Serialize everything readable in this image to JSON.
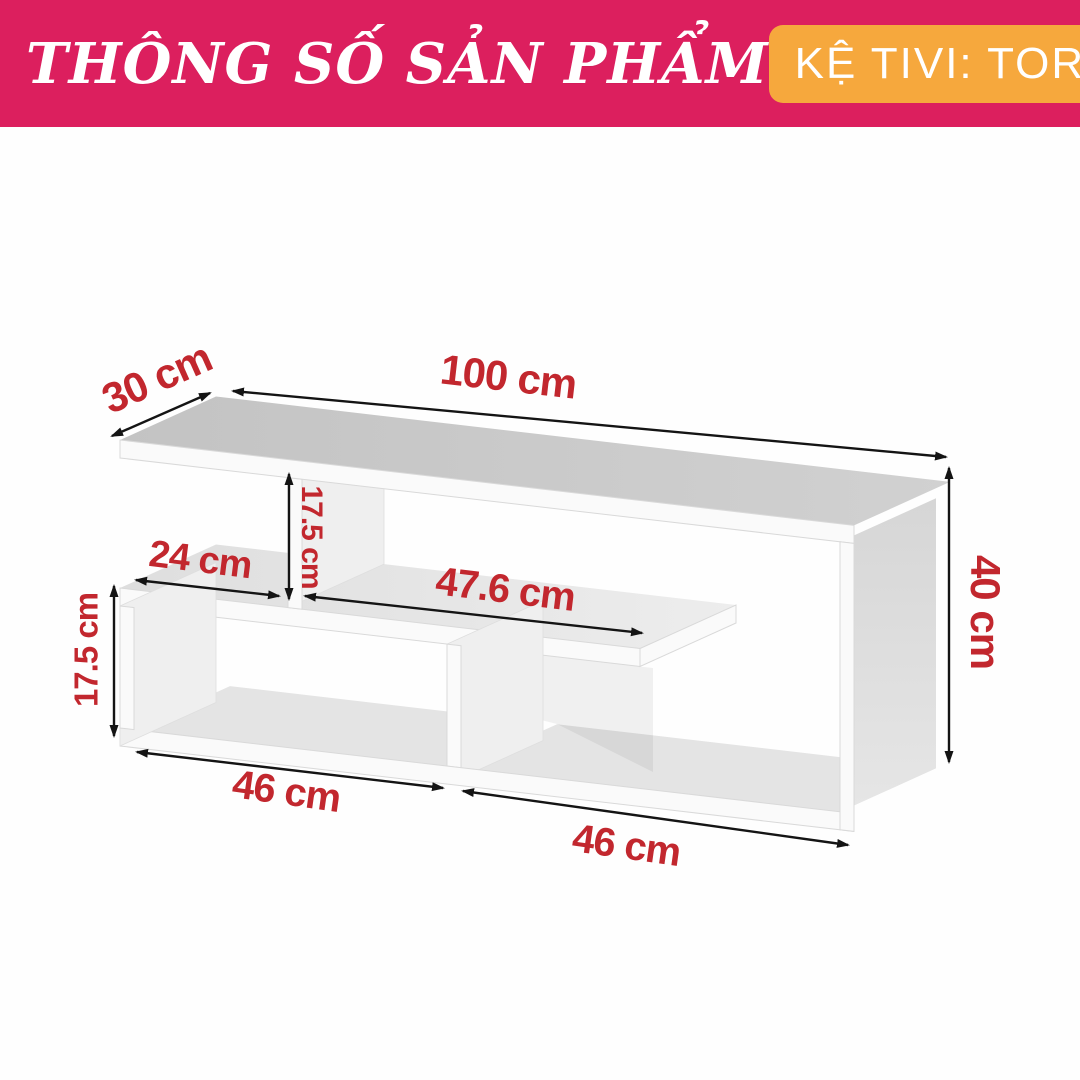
{
  "header": {
    "title": "THÔNG SỐ SẢN PHẨM",
    "badge": "KỆ TIVI: TORAH",
    "colors": {
      "banner": "#dc1f5e",
      "badge": "#f6a83d",
      "text": "#ffffff"
    }
  },
  "diagram": {
    "dimension_color": "#c2272e",
    "dimensions": {
      "depth": "30 cm",
      "width": "100 cm",
      "height": "40 cm",
      "upper_opening_height": "17.5 cm",
      "shelf_left_width": "24 cm",
      "shelf_right_width": "47.6 cm",
      "lower_opening_height": "17.5 cm",
      "bottom_left_width": "46 cm",
      "bottom_right_width": "46 cm"
    }
  }
}
